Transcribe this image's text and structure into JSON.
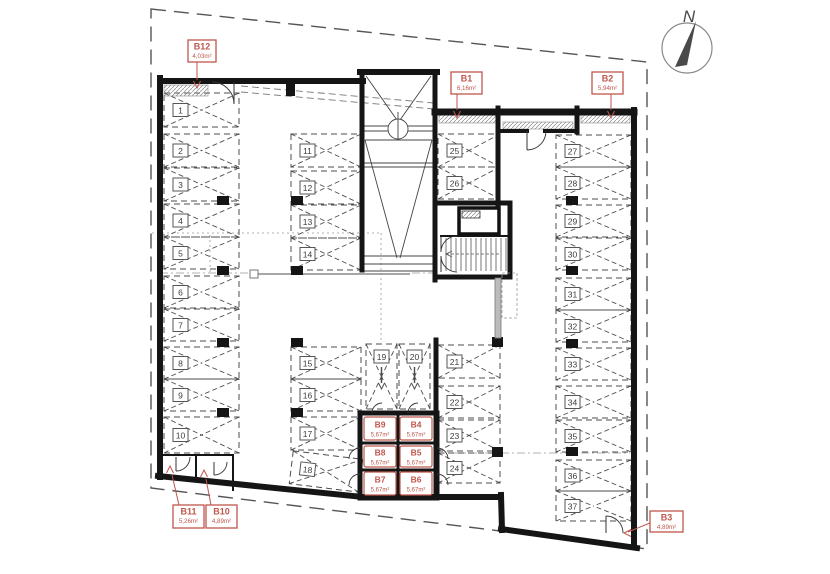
{
  "drawing": {
    "kind": "basement-parking-floor-plan",
    "north_label": "N"
  },
  "colors": {
    "accent": "#bf564c",
    "wall": "#151515",
    "stall_line": "#4d4d4d",
    "boundary": "#555555",
    "light": "#999999",
    "needle": "#4a4a4a"
  },
  "parking_spaces": [
    {
      "n": "1",
      "x": 164,
      "y": 93,
      "w": 75,
      "h": 34,
      "dir": "h"
    },
    {
      "n": "2",
      "x": 164,
      "y": 134,
      "w": 75,
      "h": 33,
      "dir": "h"
    },
    {
      "n": "3",
      "x": 164,
      "y": 168,
      "w": 75,
      "h": 33,
      "dir": "h"
    },
    {
      "n": "4",
      "x": 164,
      "y": 204,
      "w": 75,
      "h": 33,
      "dir": "h"
    },
    {
      "n": "5",
      "x": 164,
      "y": 237,
      "w": 75,
      "h": 32,
      "dir": "h"
    },
    {
      "n": "6",
      "x": 164,
      "y": 276,
      "w": 75,
      "h": 32,
      "dir": "h"
    },
    {
      "n": "7",
      "x": 164,
      "y": 309,
      "w": 75,
      "h": 32,
      "dir": "h"
    },
    {
      "n": "8",
      "x": 164,
      "y": 347,
      "w": 75,
      "h": 32,
      "dir": "h"
    },
    {
      "n": "9",
      "x": 164,
      "y": 379,
      "w": 75,
      "h": 32,
      "dir": "h"
    },
    {
      "n": "10",
      "x": 164,
      "y": 417,
      "w": 75,
      "h": 36,
      "dir": "h"
    },
    {
      "n": "11",
      "x": 291,
      "y": 134,
      "w": 70,
      "h": 33,
      "dir": "h"
    },
    {
      "n": "12",
      "x": 291,
      "y": 171,
      "w": 70,
      "h": 33,
      "dir": "h"
    },
    {
      "n": "13",
      "x": 291,
      "y": 205,
      "w": 70,
      "h": 33,
      "dir": "h"
    },
    {
      "n": "14",
      "x": 291,
      "y": 238,
      "w": 70,
      "h": 32,
      "dir": "h"
    },
    {
      "n": "15",
      "x": 291,
      "y": 347,
      "w": 70,
      "h": 32,
      "dir": "h"
    },
    {
      "n": "16",
      "x": 291,
      "y": 379,
      "w": 70,
      "h": 32,
      "dir": "h"
    },
    {
      "n": "17",
      "x": 291,
      "y": 417,
      "w": 70,
      "h": 33,
      "dir": "h"
    },
    {
      "n": "18",
      "x": 291,
      "y": 455,
      "w": 70,
      "h": 33,
      "dir": "h",
      "rot": 7
    },
    {
      "n": "19",
      "x": 366,
      "y": 344,
      "w": 31,
      "h": 65,
      "dir": "v"
    },
    {
      "n": "20",
      "x": 399,
      "y": 344,
      "w": 31,
      "h": 65,
      "dir": "v"
    },
    {
      "n": "21",
      "x": 438,
      "y": 345,
      "w": 62,
      "h": 33,
      "dir": "h"
    },
    {
      "n": "22",
      "x": 438,
      "y": 386,
      "w": 62,
      "h": 32,
      "dir": "h"
    },
    {
      "n": "23",
      "x": 438,
      "y": 420,
      "w": 62,
      "h": 31,
      "dir": "h"
    },
    {
      "n": "24",
      "x": 438,
      "y": 453,
      "w": 62,
      "h": 30,
      "dir": "h"
    },
    {
      "n": "25",
      "x": 438,
      "y": 134,
      "w": 62,
      "h": 33,
      "dir": "h"
    },
    {
      "n": "26",
      "x": 438,
      "y": 167,
      "w": 62,
      "h": 32,
      "dir": "h"
    },
    {
      "n": "27",
      "x": 556,
      "y": 135,
      "w": 75,
      "h": 32,
      "dir": "h"
    },
    {
      "n": "28",
      "x": 556,
      "y": 167,
      "w": 75,
      "h": 32,
      "dir": "h"
    },
    {
      "n": "29",
      "x": 556,
      "y": 205,
      "w": 75,
      "h": 32,
      "dir": "h"
    },
    {
      "n": "30",
      "x": 556,
      "y": 238,
      "w": 75,
      "h": 32,
      "dir": "h"
    },
    {
      "n": "31",
      "x": 556,
      "y": 278,
      "w": 75,
      "h": 32,
      "dir": "h"
    },
    {
      "n": "32",
      "x": 556,
      "y": 310,
      "w": 75,
      "h": 32,
      "dir": "h"
    },
    {
      "n": "33",
      "x": 556,
      "y": 348,
      "w": 75,
      "h": 32,
      "dir": "h"
    },
    {
      "n": "34",
      "x": 556,
      "y": 386,
      "w": 75,
      "h": 32,
      "dir": "h"
    },
    {
      "n": "35",
      "x": 556,
      "y": 420,
      "w": 75,
      "h": 32,
      "dir": "h"
    },
    {
      "n": "36",
      "x": 556,
      "y": 460,
      "w": 75,
      "h": 31,
      "dir": "h"
    },
    {
      "n": "37",
      "x": 556,
      "y": 491,
      "w": 75,
      "h": 30,
      "dir": "h"
    }
  ],
  "storage_cells": [
    {
      "name": "B9",
      "area": "5,67m²",
      "x": 364,
      "y": 417,
      "w": 32,
      "h": 23
    },
    {
      "name": "B4",
      "area": "5,67m²",
      "x": 400,
      "y": 417,
      "w": 32,
      "h": 23
    },
    {
      "name": "B8",
      "area": "5,67m²",
      "x": 364,
      "y": 446,
      "w": 32,
      "h": 21
    },
    {
      "name": "B5",
      "area": "5,67m²",
      "x": 400,
      "y": 446,
      "w": 32,
      "h": 21
    },
    {
      "name": "B7",
      "area": "5,67m²",
      "x": 364,
      "y": 472,
      "w": 32,
      "h": 23
    },
    {
      "name": "B6",
      "area": "5,67m²",
      "x": 400,
      "y": 472,
      "w": 32,
      "h": 23
    }
  ],
  "callouts": [
    {
      "name": "B12",
      "area": "4,03m²",
      "box": [
        188,
        40,
        28,
        22
      ],
      "shaft": [
        197,
        62,
        197,
        80
      ],
      "tip": [
        197,
        88
      ],
      "dir": "down"
    },
    {
      "name": "B1",
      "area": "6,16m²",
      "box": [
        451,
        72,
        31,
        22
      ],
      "shaft": [
        457,
        94,
        457,
        110
      ],
      "tip": [
        457,
        118
      ],
      "dir": "down"
    },
    {
      "name": "B2",
      "area": "5,94m²",
      "box": [
        592,
        72,
        31,
        22
      ],
      "shaft": [
        611,
        94,
        611,
        110
      ],
      "tip": [
        611,
        118
      ],
      "dir": "down"
    },
    {
      "name": "B11",
      "area": "5,26m²",
      "box": [
        173,
        505,
        31,
        23
      ],
      "shaft": [
        179,
        505,
        172,
        475
      ],
      "tip": [
        170,
        466
      ],
      "dir": "up"
    },
    {
      "name": "B10",
      "area": "4,89m²",
      "box": [
        206,
        505,
        31,
        23
      ],
      "shaft": [
        211,
        505,
        206,
        479
      ],
      "tip": [
        204,
        470
      ],
      "dir": "up"
    },
    {
      "name": "B3",
      "area": "4,89m²",
      "box": [
        650,
        511,
        33,
        21
      ],
      "shaft": [
        650,
        523,
        628,
        532
      ],
      "tip": [
        624,
        533
      ],
      "dir": "left"
    }
  ],
  "boundary": {
    "points": "151,9 647,62 647,549 151,488",
    "dash": "15,8"
  },
  "walls": [
    [
      160,
      81,
      363,
      81,
      6
    ],
    [
      360,
      72,
      437,
      72,
      6
    ],
    [
      362,
      72,
      362,
      270,
      5
    ],
    [
      435,
      72,
      435,
      280,
      5
    ],
    [
      435,
      112,
      634,
      112,
      7
    ],
    [
      634,
      110,
      634,
      546,
      6
    ],
    [
      160,
      78,
      160,
      477,
      6
    ],
    [
      158,
      476,
      363,
      497,
      6
    ],
    [
      363,
      497,
      501,
      497,
      6
    ],
    [
      501,
      495,
      502,
      530,
      6
    ],
    [
      501,
      529,
      637,
      548,
      6
    ],
    [
      498,
      108,
      498,
      205,
      5
    ],
    [
      577,
      108,
      577,
      132,
      5
    ],
    [
      498,
      131,
      527,
      131,
      4
    ],
    [
      545,
      131,
      577,
      131,
      4
    ],
    [
      436,
      340,
      436,
      498,
      5
    ],
    [
      435,
      203,
      510,
      203,
      5
    ],
    [
      510,
      203,
      510,
      277,
      5
    ],
    [
      435,
      277,
      510,
      277,
      5
    ],
    [
      441,
      236,
      510,
      236,
      2
    ],
    [
      163,
      455,
      233,
      455,
      2
    ],
    [
      196,
      455,
      196,
      478,
      2
    ],
    [
      233,
      455,
      233,
      490,
      2
    ]
  ],
  "storage_block": {
    "outer": [
      360,
      413,
      77,
      85
    ],
    "dividers": [
      [
        398,
        413,
        398,
        498,
        3
      ],
      [
        360,
        443,
        437,
        443,
        3
      ],
      [
        360,
        470,
        437,
        470,
        3
      ]
    ]
  },
  "elevator": {
    "cab": [
      459,
      208,
      40,
      26
    ],
    "motor": [
      462,
      211,
      18,
      7
    ]
  },
  "stairs": {
    "x1": 446,
    "x2": 506,
    "step": 5,
    "y1": 238,
    "y2": 271,
    "mid": [
      446,
      254,
      500,
      254
    ]
  },
  "ramp": {
    "lines": [
      [
        366,
        76,
        397,
        120
      ],
      [
        431,
        76,
        400,
        120
      ],
      [
        364,
        126,
        433,
        126
      ],
      [
        364,
        131,
        433,
        131
      ],
      [
        398,
        112,
        398,
        119
      ],
      [
        364,
        163,
        433,
        163
      ],
      [
        364,
        167,
        433,
        167
      ],
      [
        365,
        140,
        432,
        140
      ],
      [
        365,
        140,
        397,
        258
      ],
      [
        432,
        140,
        400,
        258
      ],
      [
        364,
        256,
        433,
        256
      ],
      [
        364,
        264,
        433,
        264
      ],
      [
        364,
        271,
        433,
        271
      ]
    ],
    "circle": [
      398,
      129,
      10
    ]
  },
  "columns": [
    [
      217,
      196,
      12,
      9
    ],
    [
      217,
      266,
      12,
      9
    ],
    [
      217,
      338,
      12,
      9
    ],
    [
      217,
      408,
      12,
      9
    ],
    [
      291,
      196,
      12,
      9
    ],
    [
      291,
      266,
      12,
      9
    ],
    [
      291,
      338,
      12,
      9
    ],
    [
      291,
      408,
      12,
      9
    ],
    [
      566,
      196,
      12,
      9
    ],
    [
      566,
      266,
      12,
      9
    ],
    [
      566,
      339,
      12,
      9
    ],
    [
      566,
      447,
      12,
      9
    ],
    [
      492,
      337,
      11,
      10
    ],
    [
      492,
      447,
      11,
      10
    ],
    [
      286,
      81,
      9,
      15
    ]
  ],
  "doors": [
    {
      "d": "M212,82 A22,22 0 0 1 234,104",
      "leaf": [
        234,
        82,
        234,
        104
      ]
    },
    {
      "d": "M546,131 A19,19 0 0 1 527,150",
      "leaf": [
        527,
        131,
        527,
        150
      ]
    },
    {
      "d": "M441,252 A16,16 0 0 1 457,236",
      "leaf": [
        441,
        236,
        441,
        252
      ]
    },
    {
      "d": "M441,256 A16,16 0 0 0 457,272",
      "leaf": [
        441,
        256,
        441,
        272
      ]
    },
    {
      "d": "M606,516 A17,17 0 0 1 623,533",
      "leaf": [
        606,
        533,
        606,
        516
      ]
    },
    {
      "d": "M190,457 A14,14 0 0 1 176,471",
      "leaf": [
        176,
        457,
        176,
        471
      ]
    },
    {
      "d": "M227,462 A13,13 0 0 1 214,475",
      "leaf": [
        214,
        462,
        214,
        475
      ]
    },
    {
      "d": "M360,448 A11,11 0 0 0 349,459",
      "leaf": null
    },
    {
      "d": "M360,474 A11,11 0 0 0 349,485",
      "leaf": null
    },
    {
      "d": "M437,448 A11,11 0 0 1 448,459",
      "leaf": null
    },
    {
      "d": "M437,474 A11,11 0 0 1 448,485",
      "leaf": null
    },
    {
      "d": "M372,413 A10,10 0 0 1 382,403",
      "leaf": null
    },
    {
      "d": "M408,413 A10,10 0 0 1 418,403",
      "leaf": null
    }
  ],
  "hatch_strips": [
    [
      164,
      85,
      44,
      11
    ],
    [
      439,
      115,
      57,
      8
    ],
    [
      581,
      115,
      49,
      8
    ],
    [
      503,
      122,
      70,
      7
    ]
  ],
  "light_lines": {
    "dotted": [
      [
        152,
        233,
        381,
        233
      ],
      [
        381,
        233,
        381,
        343
      ],
      [
        210,
        235,
        210,
        272
      ]
    ],
    "dashdot": [
      [
        160,
        273,
        250,
        273
      ],
      [
        412,
        273,
        434,
        273
      ],
      [
        437,
        453,
        630,
        453
      ]
    ],
    "slanted": [
      [
        241,
        86,
        434,
        103
      ],
      [
        241,
        92,
        434,
        109
      ]
    ]
  },
  "section_marker": {
    "line": [
      258,
      274,
      410,
      274
    ],
    "square": [
      250,
      270,
      8,
      8
    ]
  },
  "gray_duct": {
    "bar": [
      495,
      278,
      6,
      60
    ],
    "dashed_rect": [
      502,
      273,
      15,
      45
    ]
  },
  "north_arrow": {
    "cx": 687,
    "cy": 48,
    "r": 25,
    "needle": "675,67 696,21 687,65",
    "label_x": 689,
    "label_y": 22
  }
}
